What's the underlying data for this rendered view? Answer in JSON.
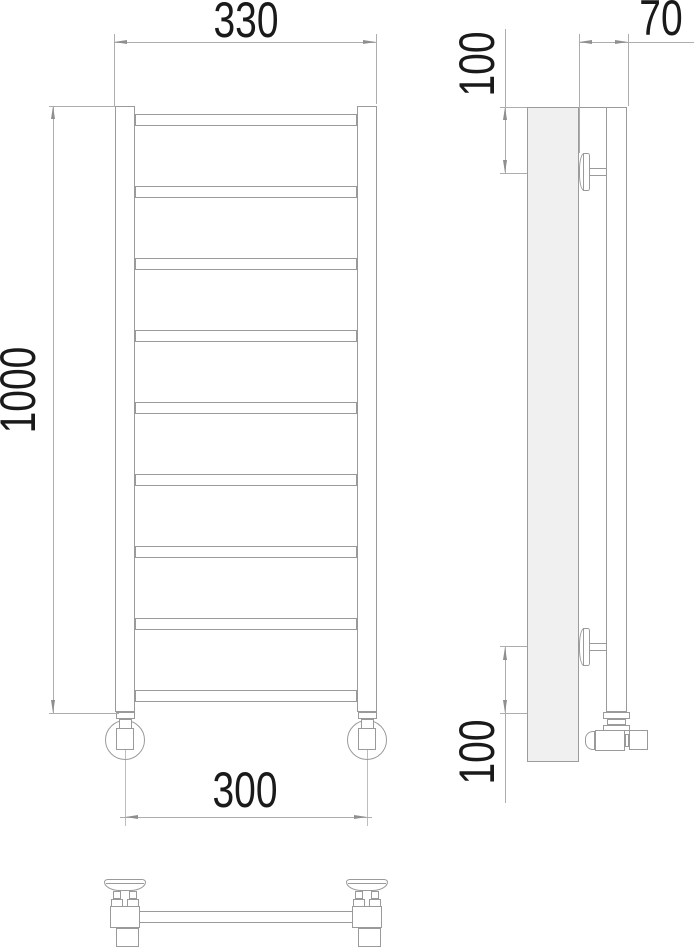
{
  "dimensions": {
    "overall_width_mm": "330",
    "height_mm": "1000",
    "connection_spacing_mm": "300",
    "depth_mm": "70",
    "top_bracket_offset_mm": "100",
    "bottom_bracket_offset_mm": "100"
  },
  "front_view": {
    "rung_count": 9,
    "rung_first_top_px": 114,
    "rung_step_px": 72
  },
  "colors": {
    "object_line": "#9a9a9a",
    "dimension_line": "#adadad",
    "centerline": "#bdbdbd",
    "arrow": "#8f8f8f",
    "text": "#1a1a1a",
    "wall_fill": "#f0f0f1",
    "background": "#ffffff"
  }
}
